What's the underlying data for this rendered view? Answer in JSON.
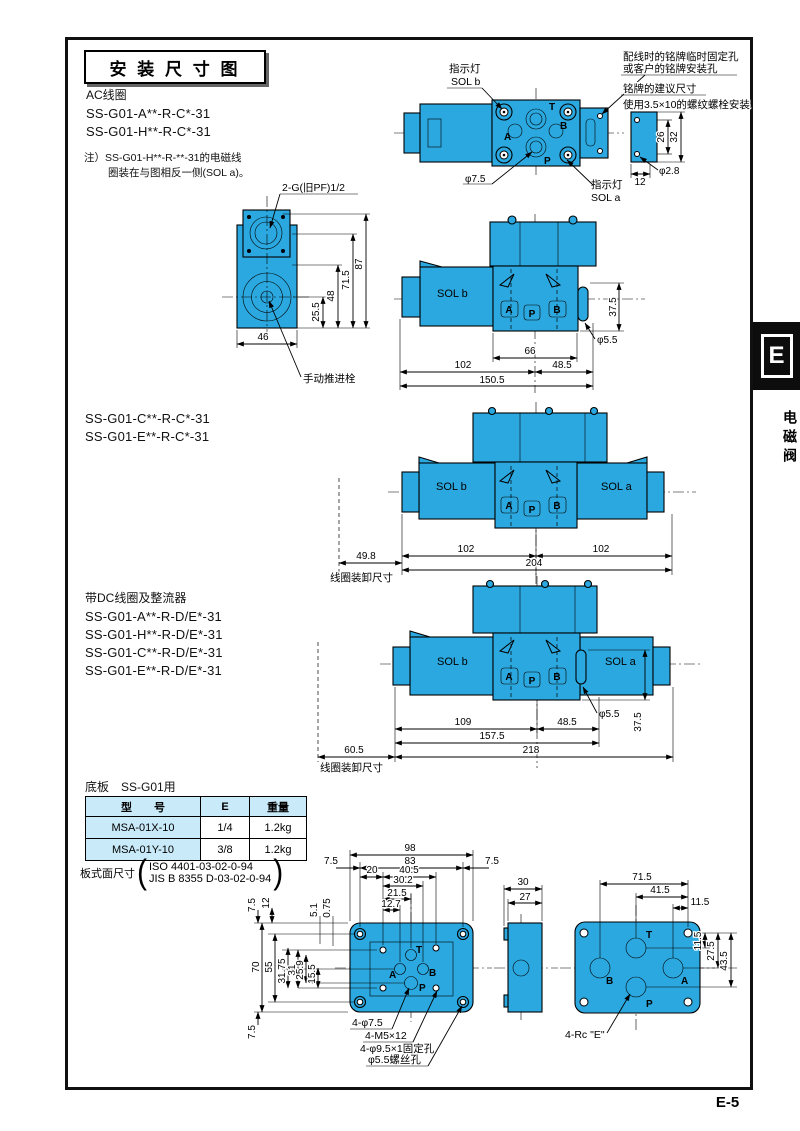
{
  "page": {
    "title": "安 装 尺 寸 图",
    "page_number": "E-5",
    "tab_letter": "E",
    "tab_label": "电磁阀"
  },
  "colors": {
    "valve_blue": "#2BA8DF",
    "table_blue": "#C9EAF8"
  },
  "sections": {
    "ac": {
      "heading": "AC线圈",
      "model1": "SS-G01-A**-R-C*-31",
      "model2": "SS-G01-H**-R-C*-31",
      "note1": "注）SS-G01-H**-R-**-31的电磁线",
      "note2": "圈装在与图相反一侧(SOL a)。"
    },
    "c_series": {
      "model1": "SS-G01-C**-R-C*-31",
      "model2": "SS-G01-E**-R-C*-31"
    },
    "dc": {
      "heading": "带DC线圈及整流器",
      "model1": "SS-G01-A**-R-D/E*-31",
      "model2": "SS-G01-H**-R-D/E*-31",
      "model3": "SS-G01-C**-R-D/E*-31",
      "model4": "SS-G01-E**-R-D/E*-31"
    },
    "subplate": {
      "heading": "底板　SS-G01用",
      "headers": [
        "型　　号",
        "E",
        "重量"
      ],
      "rows": [
        [
          "MSA-01X-10",
          "1/4",
          "1.2kg"
        ],
        [
          "MSA-01Y-10",
          "3/8",
          "1.2kg"
        ]
      ],
      "surface_label": "板式面尺寸",
      "iso": "ISO 4401-03-02-0-94",
      "jis": "JIS B 8355 D-03-02-0-94"
    }
  },
  "topview": {
    "lamp_b1": "指示灯",
    "lamp_b2": "SOL b",
    "lamp_a1": "指示灯",
    "lamp_a2": "SOL a",
    "fix1": "配线时的铭牌临时固定孔",
    "fix2": "或客户的铭牌安装孔",
    "plate_note": "铭牌的建议尺寸",
    "bolt_note": "使用3.5×10的螺纹螺栓安装",
    "t": "T",
    "b": "B",
    "a": "A",
    "p": "P",
    "dia75": "φ7.5",
    "d26": "26",
    "d32": "32",
    "d12": "12",
    "dia28": "φ2.8"
  },
  "leftview": {
    "thread": "2-G(旧PF)1/2",
    "d87": "87",
    "d715": "71.5",
    "d48": "48",
    "d255": "25.5",
    "d46": "46",
    "manual": "手动推进栓"
  },
  "valve1": {
    "sol_b": "SOL b",
    "a": "A",
    "p": "P",
    "b": "B",
    "d375": "37.5",
    "dia55": "φ5.5",
    "d66": "66",
    "d102": "102",
    "d485": "48.5",
    "d1505": "150.5"
  },
  "valve2": {
    "sol_b": "SOL b",
    "sol_a": "SOL a",
    "a": "A",
    "p": "P",
    "b": "B",
    "d102l": "102",
    "d102r": "102",
    "d204": "204",
    "d498": "49.8",
    "removal": "线圈装卸尺寸"
  },
  "valve3": {
    "sol_b": "SOL b",
    "sol_a": "SOL a",
    "a": "A",
    "p": "P",
    "b": "B",
    "d109": "109",
    "d485": "48.5",
    "d1575": "157.5",
    "d218": "218",
    "d605": "60.5",
    "dia55": "φ5.5",
    "d375": "37.5",
    "removal": "线圈装卸尺寸"
  },
  "plate": {
    "d98": "98",
    "d83": "83",
    "d75l": "7.5",
    "d75r": "7.5",
    "d20": "20",
    "d405": "40.5",
    "d302": "30.2",
    "d215": "21.5",
    "d127": "12.7",
    "d75t": "7.5",
    "d12": "12",
    "d51": "5.1",
    "d075": "0.75",
    "d70": "70",
    "d55": "55",
    "d3175": "31.75",
    "d31": "31",
    "d259": "25.9",
    "d155": "15.5",
    "d75b": "7.5",
    "t": "T",
    "a": "A",
    "b": "B",
    "p": "P",
    "holes1": "4-φ7.5",
    "holes2": "4-M5×12",
    "holes3": "4-φ9.5×1固定孔",
    "holes4": "φ5.5螺丝孔",
    "d30": "30",
    "d27": "27",
    "rt": "T",
    "rb": "B",
    "ra": "A",
    "rp": "P",
    "d715": "71.5",
    "d415": "41.5",
    "d115h": "11.5",
    "d115v": "11.5",
    "d275": "27.5",
    "d435": "43.5",
    "rc": "4-Rc \"E\""
  }
}
